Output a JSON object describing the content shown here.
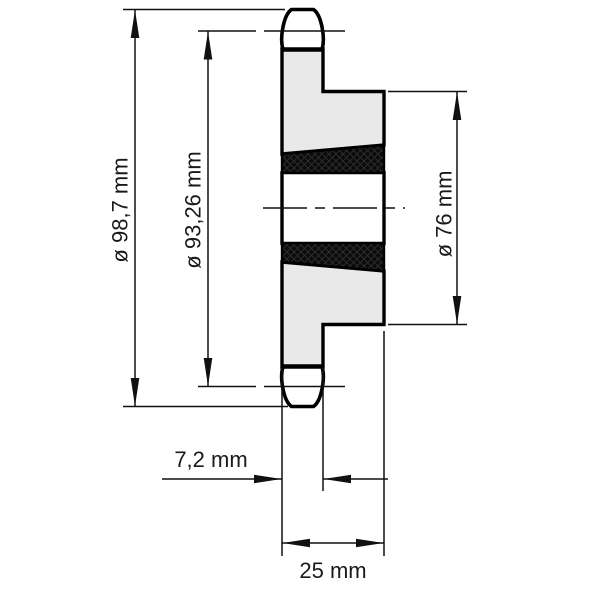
{
  "title": "Sprocket cross-section technical drawing",
  "dimensions": {
    "outer_diameter": "ø 98,7 mm",
    "pitch_diameter": "ø 93,26 mm",
    "hub_diameter": "ø 76 mm",
    "tooth_width": "7,2 mm",
    "hub_width": "25 mm"
  },
  "colors": {
    "background": "#ffffff",
    "body_fill": "#e9e9e9",
    "tooth_fill": "#ffffff",
    "hatch_fill": "#0b0b0b",
    "outline": "#000000",
    "dimension_line": "#111111",
    "text": "#1a1a1a"
  }
}
